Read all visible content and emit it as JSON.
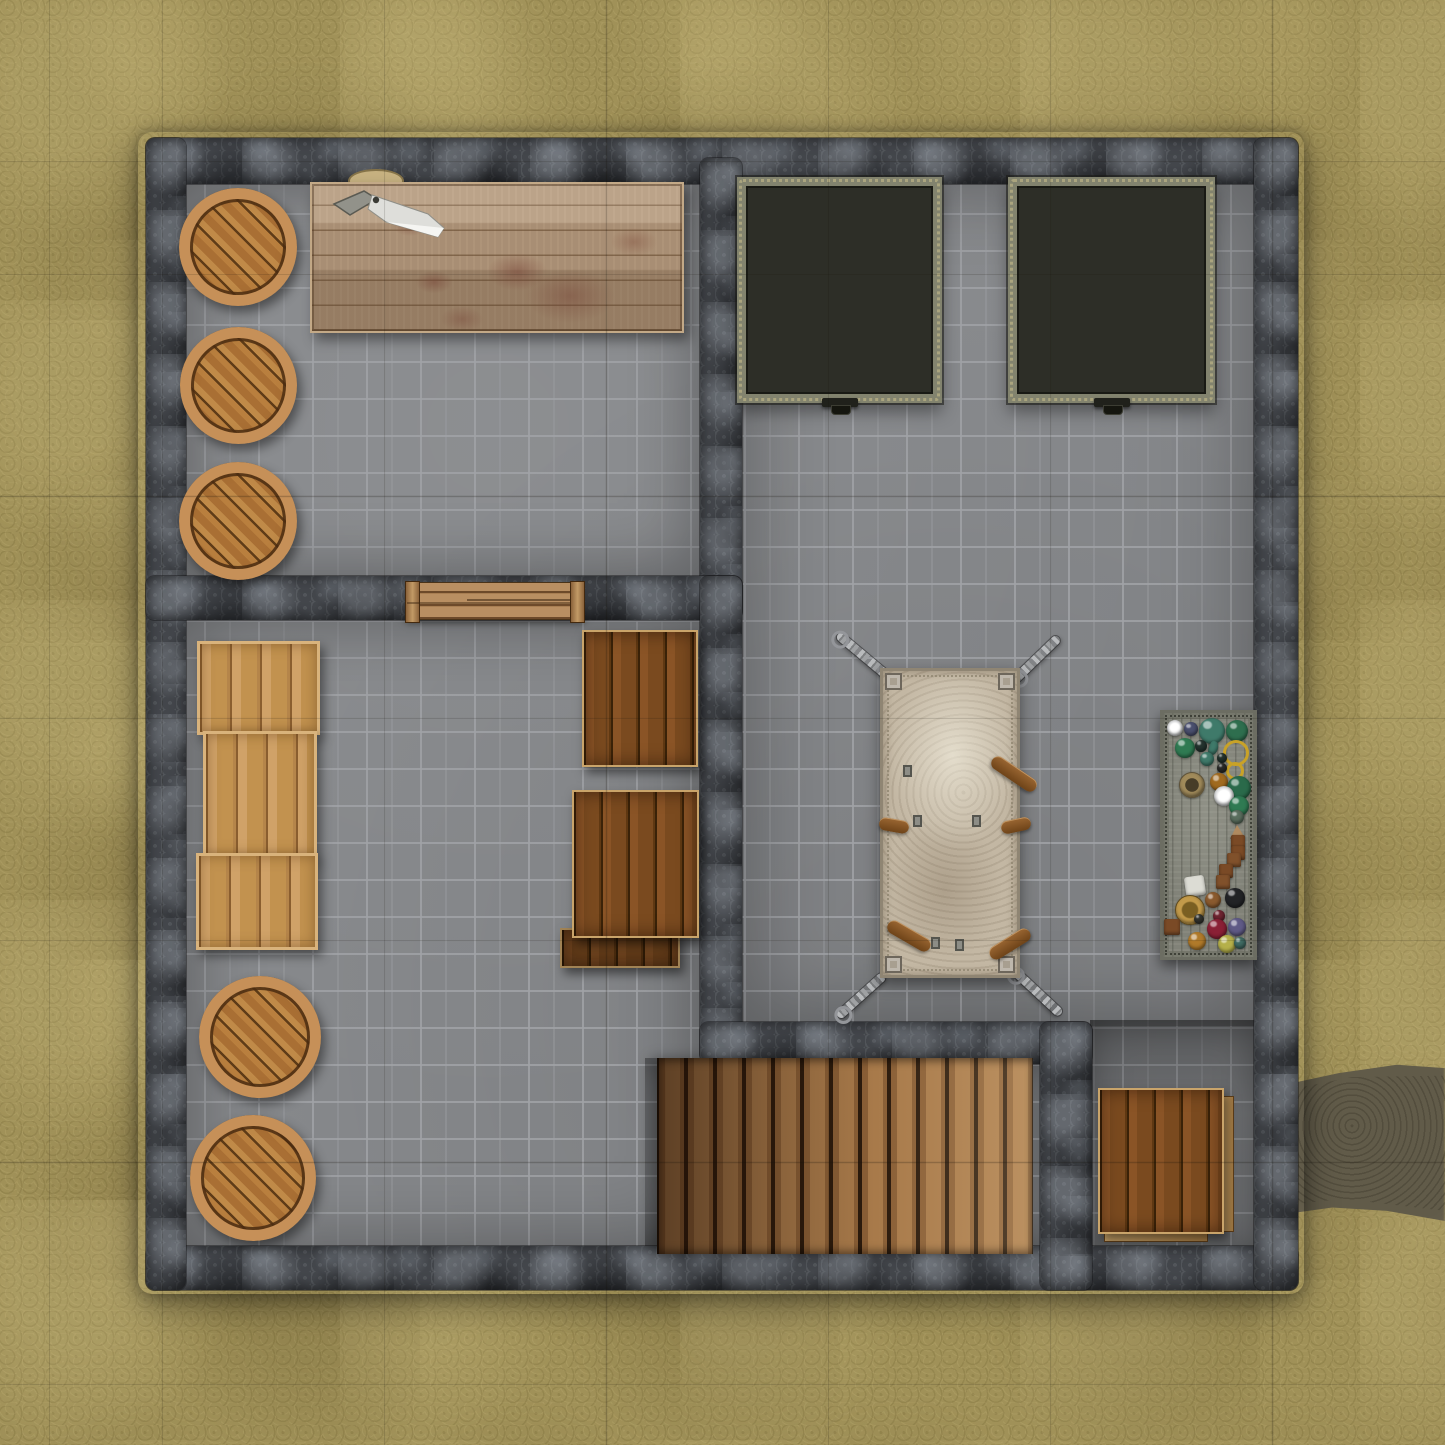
{
  "map": {
    "title": "dungeon-basement-battle-map",
    "grid": {
      "visible": true,
      "cell_size_px": 222,
      "offset_px": 162,
      "cols_visible": 6.5,
      "rows_visible": 6.5
    },
    "palette": {
      "ground": "#a09158",
      "ground_light": "#b2a46b",
      "ground_dark": "#8d7f4c",
      "dirt_trail": "#655f4d",
      "floor": "#86888b",
      "floor_mortar": "#a0a2a6",
      "wall": "#43464b",
      "wall_light": "#7d8288",
      "wall_dark": "#26282c",
      "barrel_wood": "#b97f3e",
      "barrel_rim": "#c69058",
      "crate_light": "#c2924f",
      "crate_dark": "#7a4a1f",
      "table_wood": "#ae947a",
      "blood_stain": "#7a4a3c",
      "stairs_dark": "#5a4026",
      "stairs_light": "#c59a6b",
      "grate_bar": "#a6a796",
      "grate_cell": "#2d2e27",
      "rack_surface": "#c3b7a3",
      "leather_strap": "#8a5a2a",
      "chain_metal": "#9fa1a3",
      "alchemy_table": "#818278",
      "door_wood": "#b98f62"
    },
    "rooms": [
      {
        "id": "storage-room",
        "position": "top-left",
        "contents": [
          "barrel x3",
          "butcher table with cleaver and blood stains",
          "cutting board"
        ]
      },
      {
        "id": "cell-room",
        "position": "right",
        "contents": [
          "iron floor grate x2",
          "torture rack with chains",
          "alchemy table with potions"
        ]
      },
      {
        "id": "supply-room",
        "position": "bottom-left",
        "contents": [
          "light crate stack x3",
          "barrel x2",
          "dark crate x3"
        ]
      },
      {
        "id": "stair-alcove",
        "position": "bottom-center",
        "contents": [
          "wooden staircase"
        ]
      },
      {
        "id": "storage-nook",
        "position": "bottom-right",
        "contents": [
          "dark crate with loose plank"
        ]
      }
    ],
    "objects": {
      "barrels": {
        "label": "wooden barrel",
        "count": 5,
        "items": [
          {
            "x": 238,
            "y": 247,
            "d": 118
          },
          {
            "x": 238,
            "y": 385,
            "d": 117
          },
          {
            "x": 238,
            "y": 521,
            "d": 118
          },
          {
            "x": 260,
            "y": 1037,
            "d": 122
          },
          {
            "x": 253,
            "y": 1178,
            "d": 126
          }
        ]
      },
      "butcher_table": {
        "label": "blood-stained butcher table",
        "props": [
          "cleaver",
          "cutting board",
          "blood stains x6"
        ]
      },
      "floor_grates": {
        "label": "iron floor grate with pull handle",
        "count": 2
      },
      "torture_rack": {
        "label": "torture rack",
        "chains": 4,
        "straps": 5,
        "corner_plates": 4
      },
      "alchemy_table": {
        "label": "table with potions, rings, pouches and tools",
        "items": [
          {
            "shape": "plate",
            "x": 15,
            "y": 18,
            "r": 8,
            "c": "#d8d8d2"
          },
          {
            "shape": "orb",
            "x": 31,
            "y": 19,
            "r": 7,
            "c": "#4a4f6e"
          },
          {
            "shape": "flask",
            "x": 52,
            "y": 21,
            "r": 13,
            "c": "#3f7a6a"
          },
          {
            "shape": "orb",
            "x": 77,
            "y": 21,
            "r": 11,
            "c": "#2e6e4e"
          },
          {
            "shape": "orb",
            "x": 25,
            "y": 38,
            "r": 10,
            "c": "#2f7a52"
          },
          {
            "shape": "orb",
            "x": 41,
            "y": 36,
            "r": 6,
            "c": "#24332e"
          },
          {
            "shape": "ring",
            "x": 76,
            "y": 43,
            "r": 13,
            "c": "#c9a227"
          },
          {
            "shape": "orb",
            "x": 47,
            "y": 49,
            "r": 7,
            "c": "#3f7a6a"
          },
          {
            "shape": "orb",
            "x": 62,
            "y": 48,
            "r": 5,
            "c": "#24332e"
          },
          {
            "shape": "ring",
            "x": 75,
            "y": 61,
            "r": 9,
            "c": "#c9a227"
          },
          {
            "shape": "orb",
            "x": 62,
            "y": 58,
            "r": 5,
            "c": "#2a2a28"
          },
          {
            "shape": "orb",
            "x": 59,
            "y": 72,
            "r": 9,
            "c": "#a06a1f"
          },
          {
            "shape": "mortar",
            "x": 32,
            "y": 75,
            "r": 13,
            "c": "#a08a5a"
          },
          {
            "shape": "orb",
            "x": 79,
            "y": 78,
            "r": 12,
            "c": "#2a6a4a"
          },
          {
            "shape": "plate",
            "x": 64,
            "y": 86,
            "r": 10,
            "c": "#c9cacb"
          },
          {
            "shape": "orb",
            "x": 79,
            "y": 96,
            "r": 10,
            "c": "#2f7a52"
          },
          {
            "shape": "orb",
            "x": 77,
            "y": 107,
            "r": 7,
            "c": "#5a6e5e"
          },
          {
            "shape": "shard",
            "x": 77,
            "y": 122,
            "r": 7,
            "c": "#b08a5f"
          },
          {
            "shape": "box",
            "x": 78,
            "y": 132,
            "r": 7,
            "c": "#7a4a26"
          },
          {
            "shape": "box",
            "x": 78,
            "y": 143,
            "r": 7,
            "c": "#7a4a26"
          },
          {
            "shape": "box",
            "x": 74,
            "y": 150,
            "r": 7,
            "c": "#80512b"
          },
          {
            "shape": "box",
            "x": 66,
            "y": 161,
            "r": 7,
            "c": "#7a4a26"
          },
          {
            "shape": "box",
            "x": 63,
            "y": 172,
            "r": 7,
            "c": "#80512b"
          },
          {
            "shape": "cloth",
            "x": 35,
            "y": 176,
            "r": 10,
            "c": "#dcdcd4"
          },
          {
            "shape": "orb",
            "x": 53,
            "y": 190,
            "r": 8,
            "c": "#8a5a2e"
          },
          {
            "shape": "orb",
            "x": 75,
            "y": 188,
            "r": 10,
            "c": "#222326"
          },
          {
            "shape": "bowl",
            "x": 30,
            "y": 200,
            "r": 15,
            "c": "#b08a3f"
          },
          {
            "shape": "box",
            "x": 12,
            "y": 217,
            "r": 8,
            "c": "#7a4a26"
          },
          {
            "shape": "orb",
            "x": 59,
            "y": 206,
            "r": 6,
            "c": "#6e2430"
          },
          {
            "shape": "orb",
            "x": 57,
            "y": 219,
            "r": 10,
            "c": "#8a2035"
          },
          {
            "shape": "orb",
            "x": 77,
            "y": 217,
            "r": 9,
            "c": "#5f5a86"
          },
          {
            "shape": "orb",
            "x": 39,
            "y": 209,
            "r": 5,
            "c": "#33342e"
          },
          {
            "shape": "orb",
            "x": 37,
            "y": 231,
            "r": 9,
            "c": "#b07a2a"
          },
          {
            "shape": "orb",
            "x": 67,
            "y": 234,
            "r": 9,
            "c": "#b5b04a"
          },
          {
            "shape": "orb",
            "x": 80,
            "y": 233,
            "r": 6,
            "c": "#3f6a62"
          }
        ]
      },
      "light_crates": {
        "label": "pine crate stack",
        "count": 3
      },
      "dark_crates": {
        "label": "dark wooden crate",
        "count": 4
      },
      "stairs": {
        "label": "wooden staircase descending",
        "planks": 13
      },
      "door": {
        "label": "wooden door in wall",
        "orientation": "horizontal"
      },
      "dirt_trail": {
        "label": "dirt trail exiting east"
      }
    }
  }
}
